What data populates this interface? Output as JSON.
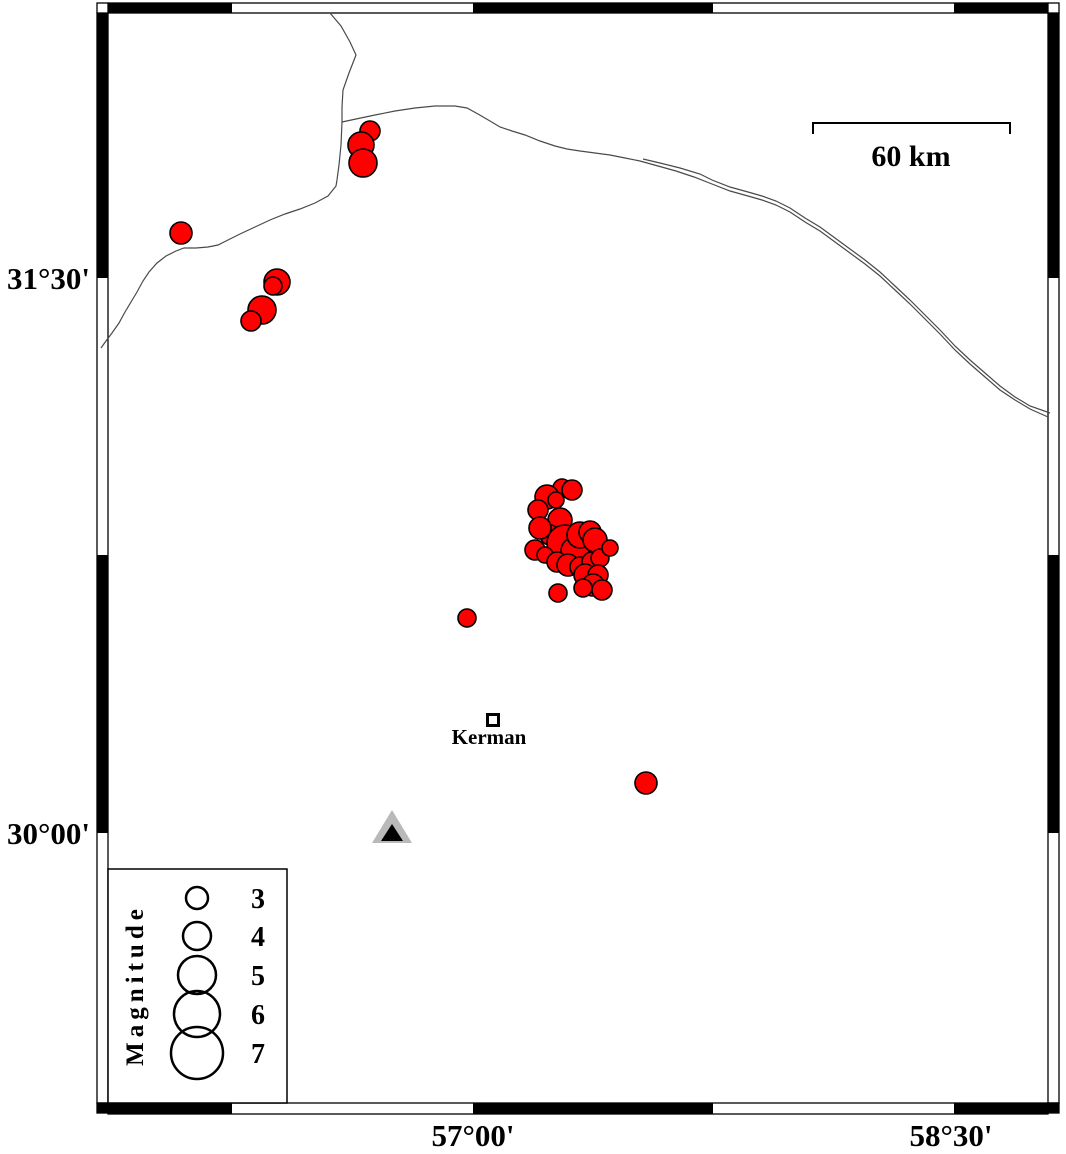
{
  "figure": {
    "width": 1066,
    "height": 1154,
    "background": "#ffffff"
  },
  "frame": {
    "outer": {
      "left": 97,
      "top": 3,
      "right": 1059,
      "bottom": 1114
    },
    "inner": {
      "left": 108,
      "top": 13,
      "right": 1048,
      "bottom": 1103
    },
    "x_boundaries": [
      108,
      232,
      473,
      713,
      954,
      1048
    ],
    "y_boundaries": [
      13,
      278,
      555,
      833,
      1103
    ],
    "corner_colors": {
      "top_left": "#ffffff",
      "top_right": "#ffffff",
      "bottom_left": "#000000",
      "bottom_right": "#000000"
    },
    "x_ticks": [
      {
        "label": "57°00'",
        "x": 473
      },
      {
        "label": "58°30'",
        "x": 951
      }
    ],
    "y_ticks": [
      {
        "label": "31°30'",
        "y": 278
      },
      {
        "label": "30°00'",
        "y": 833
      }
    ]
  },
  "scale_bar": {
    "label": "60 km",
    "x1": 813,
    "x2": 1010,
    "y": 123,
    "tick_drop": 11
  },
  "city": {
    "name": "Kerman"
  },
  "station": {
    "cx": 392,
    "apex_y": 810,
    "base_y": 843,
    "half_width": 20,
    "inner": {
      "apex_y": 824,
      "base_y": 841,
      "half_width": 11
    },
    "fill": "#b9b9b9",
    "inner_fill": "#000000"
  },
  "legend": {
    "title": "Magnitude",
    "box": {
      "x": 108,
      "y": 869,
      "w": 179,
      "h": 234
    },
    "circle_x": 197,
    "label_x": 258,
    "entries": [
      {
        "label": "3",
        "r": 11,
        "cy": 898
      },
      {
        "label": "4",
        "r": 14,
        "cy": 936
      },
      {
        "label": "5",
        "r": 19,
        "cy": 975
      },
      {
        "label": "6",
        "r": 23,
        "cy": 1014
      },
      {
        "label": "7",
        "r": 26,
        "cy": 1053
      }
    ]
  },
  "earthquakes": {
    "color": "#ff0000",
    "outline": "#000000",
    "points": [
      [
        370,
        131,
        10
      ],
      [
        361,
        145,
        13
      ],
      [
        363,
        163,
        14
      ],
      [
        181,
        233,
        11
      ],
      [
        277,
        282,
        13
      ],
      [
        273,
        286,
        9
      ],
      [
        262,
        310,
        14
      ],
      [
        251,
        321,
        10
      ],
      [
        562,
        488,
        9
      ],
      [
        572,
        490,
        10
      ],
      [
        547,
        497,
        12
      ],
      [
        556,
        500,
        8
      ],
      [
        538,
        510,
        10
      ],
      [
        560,
        520,
        12
      ],
      [
        550,
        535,
        10
      ],
      [
        540,
        528,
        11
      ],
      [
        565,
        543,
        18
      ],
      [
        575,
        551,
        14
      ],
      [
        580,
        535,
        13
      ],
      [
        590,
        532,
        11
      ],
      [
        595,
        540,
        12
      ],
      [
        535,
        550,
        10
      ],
      [
        545,
        555,
        8
      ],
      [
        557,
        562,
        10
      ],
      [
        568,
        565,
        11
      ],
      [
        580,
        567,
        10
      ],
      [
        592,
        562,
        10
      ],
      [
        600,
        558,
        9
      ],
      [
        610,
        548,
        8
      ],
      [
        585,
        575,
        11
      ],
      [
        598,
        575,
        10
      ],
      [
        593,
        585,
        11
      ],
      [
        583,
        588,
        9
      ],
      [
        602,
        590,
        10
      ],
      [
        558,
        593,
        9
      ],
      [
        467,
        618,
        9
      ],
      [
        646,
        783,
        11
      ]
    ]
  },
  "map_lines": {
    "color": "#4a4a4a",
    "paths": [
      [
        [
          330,
          13
        ],
        [
          341,
          26
        ],
        [
          350,
          42
        ],
        [
          356,
          55
        ],
        [
          349,
          73
        ],
        [
          343,
          90
        ],
        [
          342,
          107
        ],
        [
          342,
          122
        ],
        [
          341,
          145
        ],
        [
          339,
          165
        ],
        [
          337,
          180
        ],
        [
          336,
          186
        ],
        [
          328,
          196
        ],
        [
          315,
          203
        ],
        [
          300,
          209
        ],
        [
          285,
          214
        ],
        [
          270,
          220
        ],
        [
          255,
          227
        ],
        [
          240,
          234
        ],
        [
          228,
          240
        ],
        [
          218,
          245
        ],
        [
          208,
          247
        ],
        [
          196,
          248
        ],
        [
          184,
          248
        ],
        [
          176,
          251
        ],
        [
          166,
          256
        ],
        [
          157,
          263
        ],
        [
          149,
          272
        ],
        [
          143,
          281
        ],
        [
          137,
          292
        ],
        [
          131,
          302
        ],
        [
          125,
          312
        ],
        [
          119,
          323
        ],
        [
          112,
          333
        ],
        [
          106,
          341
        ],
        [
          101,
          348
        ]
      ],
      [
        [
          342,
          122
        ],
        [
          356,
          119
        ],
        [
          375,
          115
        ],
        [
          395,
          111
        ],
        [
          415,
          108
        ],
        [
          435,
          106
        ],
        [
          455,
          106
        ],
        [
          467,
          108
        ],
        [
          478,
          114
        ],
        [
          490,
          121
        ],
        [
          500,
          127
        ],
        [
          512,
          131
        ],
        [
          525,
          135
        ],
        [
          540,
          141
        ],
        [
          555,
          146
        ],
        [
          567,
          149
        ],
        [
          580,
          151
        ],
        [
          595,
          153
        ],
        [
          610,
          155
        ],
        [
          625,
          158
        ],
        [
          640,
          161
        ]
      ],
      [
        [
          640,
          161
        ],
        [
          658,
          166
        ],
        [
          676,
          171
        ],
        [
          694,
          177
        ],
        [
          712,
          184
        ],
        [
          730,
          191
        ],
        [
          748,
          196
        ],
        [
          762,
          200
        ],
        [
          776,
          205
        ],
        [
          790,
          212
        ],
        [
          805,
          222
        ],
        [
          820,
          231
        ],
        [
          835,
          242
        ],
        [
          850,
          253
        ],
        [
          865,
          264
        ],
        [
          880,
          276
        ],
        [
          895,
          290
        ],
        [
          910,
          304
        ],
        [
          925,
          319
        ],
        [
          940,
          334
        ],
        [
          955,
          350
        ],
        [
          970,
          364
        ],
        [
          985,
          377
        ],
        [
          1000,
          390
        ],
        [
          1015,
          400
        ],
        [
          1030,
          409
        ],
        [
          1048,
          417
        ]
      ],
      [
        [
          643,
          159
        ],
        [
          660,
          163
        ],
        [
          680,
          168
        ],
        [
          700,
          174
        ],
        [
          712,
          180
        ],
        [
          730,
          187
        ],
        [
          748,
          192
        ],
        [
          762,
          196
        ],
        [
          776,
          201
        ],
        [
          790,
          208
        ],
        [
          805,
          218
        ],
        [
          820,
          227
        ],
        [
          835,
          238
        ],
        [
          850,
          249
        ],
        [
          865,
          260
        ],
        [
          880,
          272
        ],
        [
          895,
          286
        ],
        [
          910,
          300
        ],
        [
          925,
          315
        ],
        [
          940,
          330
        ],
        [
          955,
          346
        ],
        [
          970,
          360
        ],
        [
          985,
          373
        ],
        [
          1000,
          386
        ],
        [
          1015,
          397
        ],
        [
          1030,
          406
        ],
        [
          1050,
          413
        ]
      ]
    ]
  }
}
